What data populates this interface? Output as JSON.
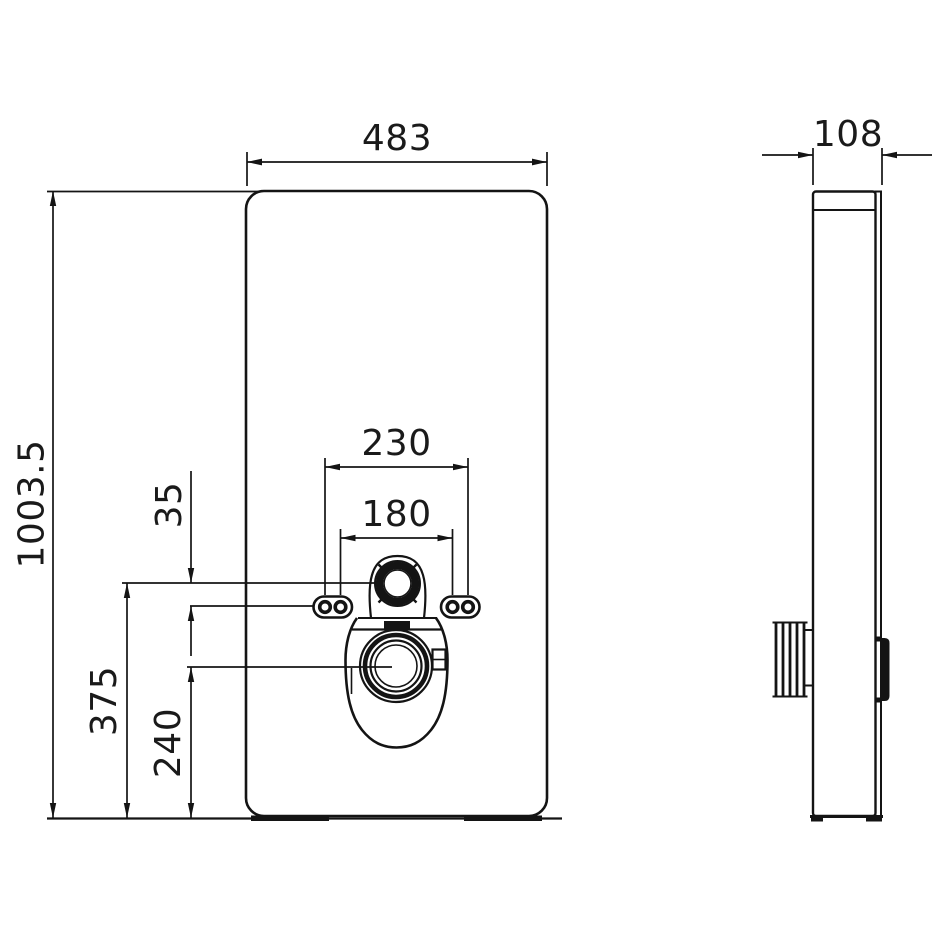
{
  "page": {
    "background_color": "#ffffff",
    "line_color": "#141414"
  },
  "drawing": {
    "front_view": {
      "dim_width": "483",
      "dim_height": "1003.5",
      "dim_fixing_outer": "230",
      "dim_fixing_inner": "180",
      "dim_supply_to_fixing": "35",
      "dim_supply_height": "375",
      "dim_outlet_height": "240"
    },
    "side_view": {
      "dim_depth": "108"
    }
  }
}
